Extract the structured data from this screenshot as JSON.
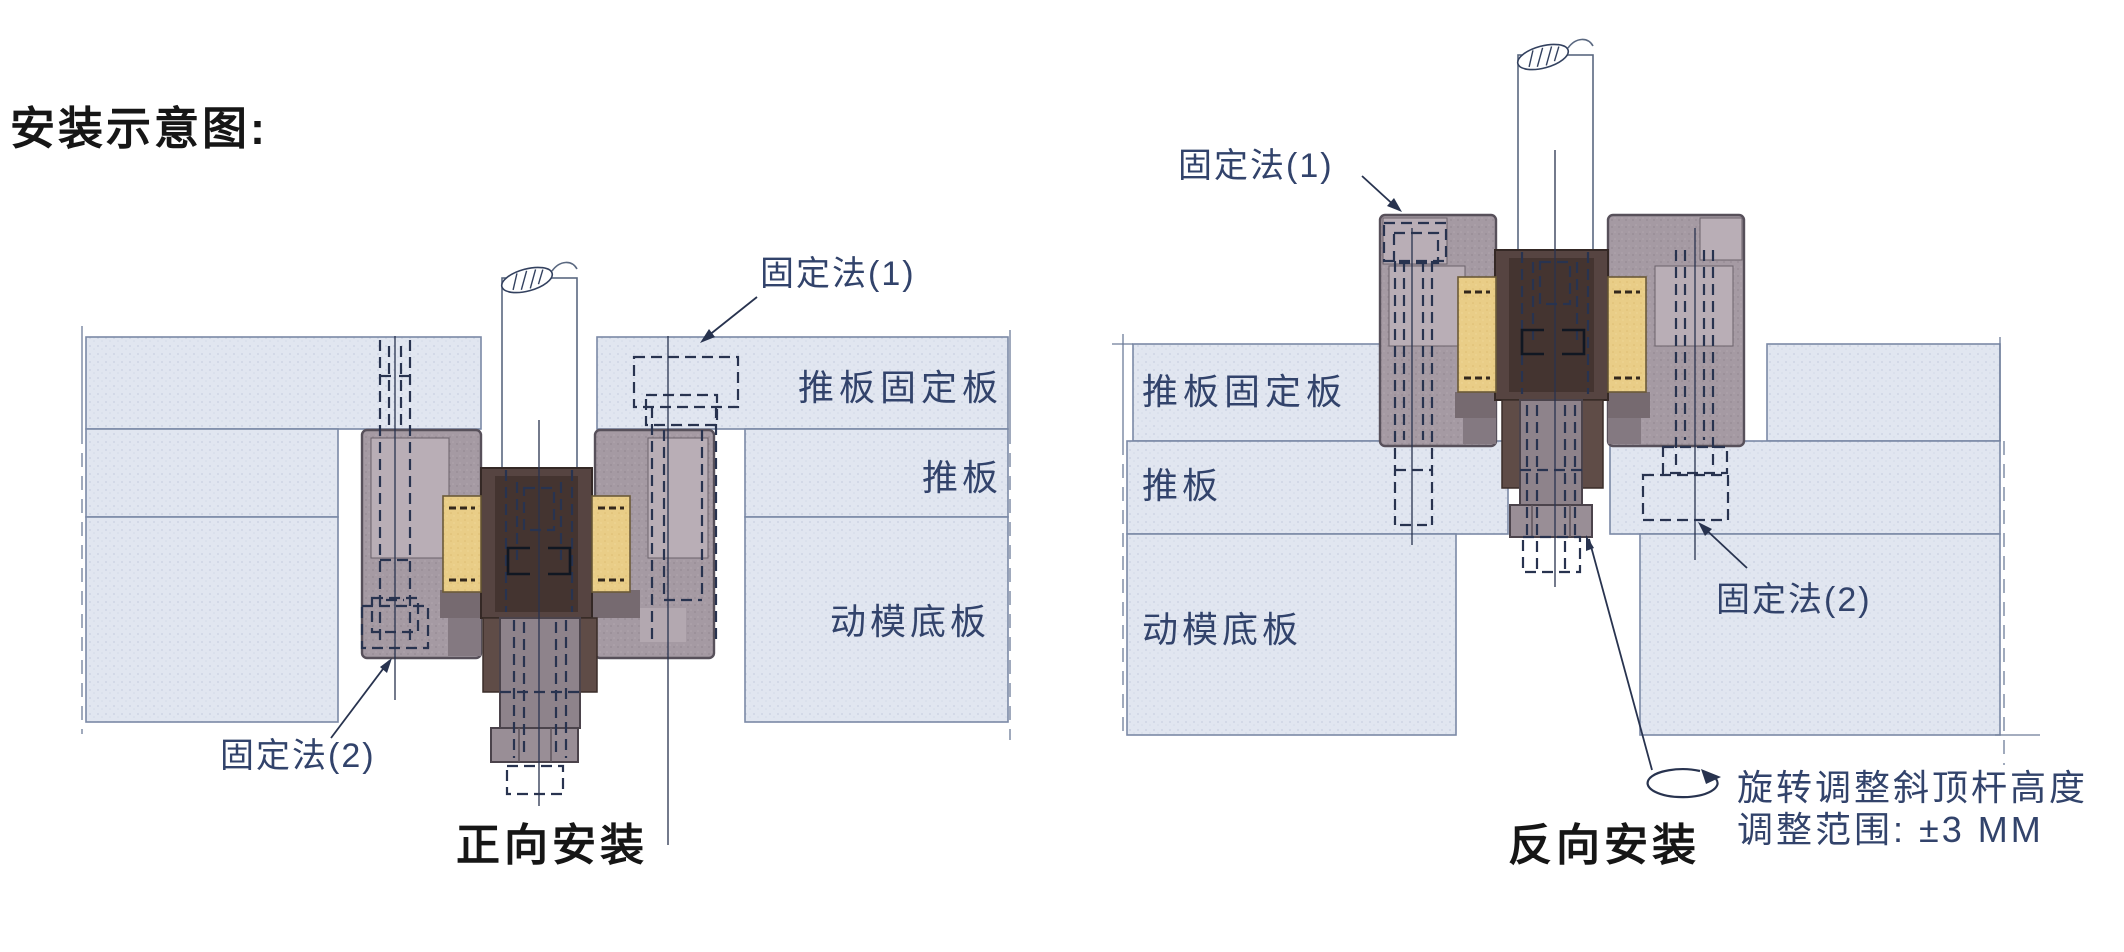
{
  "title": "安装示意图:",
  "forward": {
    "caption": "正向安装",
    "fixing1_label": "固定法(1)",
    "fixing2_label": "固定法(2)",
    "plate_labels": [
      "推板固定板",
      "推板",
      "动模底板"
    ]
  },
  "reverse": {
    "caption": "反向安装",
    "fixing1_label": "固定法(1)",
    "fixing2_label": "固定法(2)",
    "plate_labels": [
      "推板固定板",
      "推板",
      "动模底板"
    ],
    "adjust_note_line1": "旋转调整斜顶杆高度",
    "adjust_note_line2": "调整范围: ±3 MM"
  },
  "colors": {
    "plate_fill": "#e1e6f0",
    "plate_border": "#7b89a6",
    "clamp_fill": "#a59aa3",
    "block_fill": "#564441",
    "yellow_fill": "#e9cd87",
    "label_navy": "#32436b",
    "text_black": "#161616"
  }
}
